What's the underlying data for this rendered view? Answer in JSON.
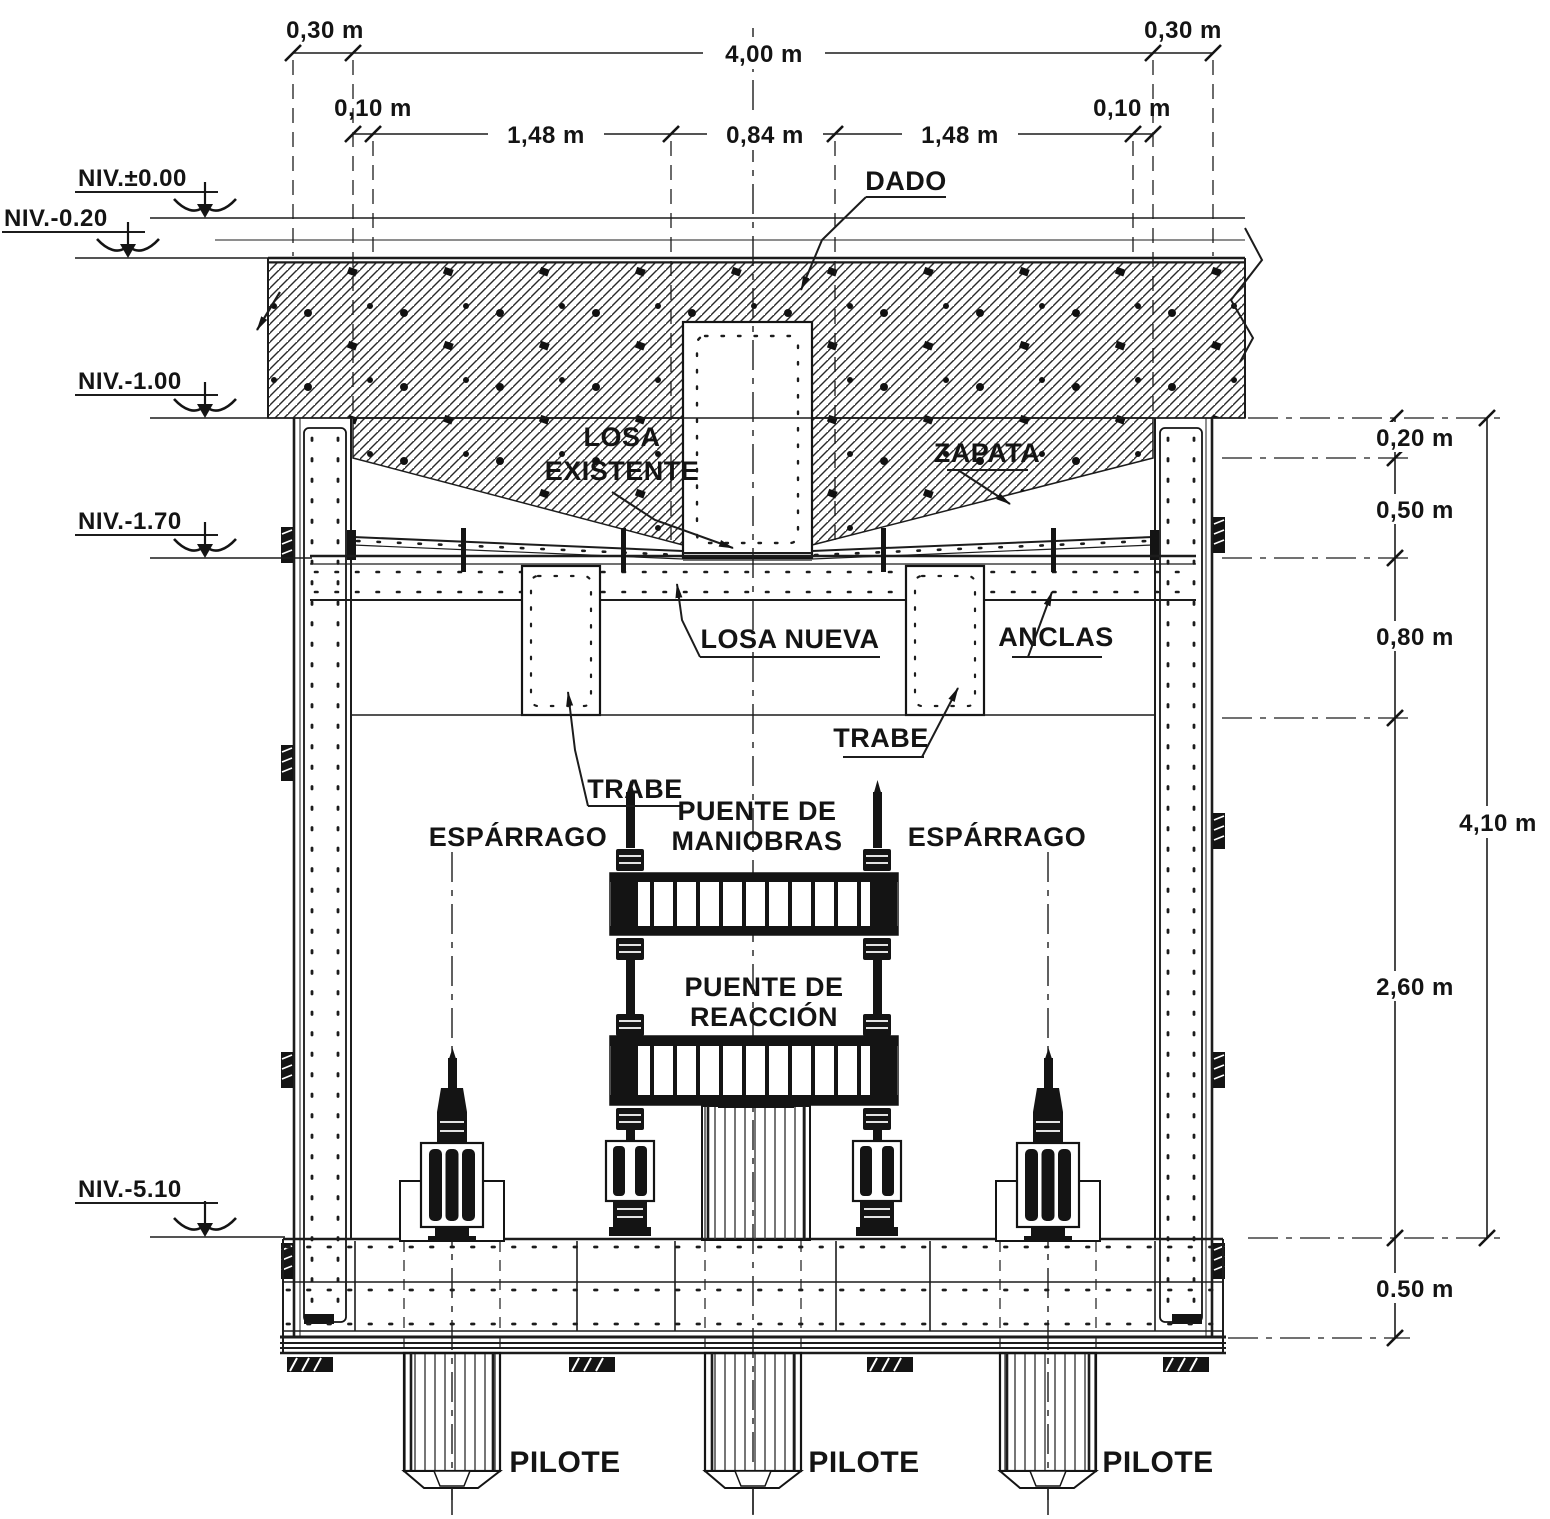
{
  "dims_top": {
    "d030_left": "0,30 m",
    "d400": "4,00 m",
    "d030_right": "0,30 m",
    "d010_left": "0,10 m",
    "d148_left": "1,48 m",
    "d084": "0,84 m",
    "d148_right": "1,48 m",
    "d010_right": "0,10 m"
  },
  "dims_right": {
    "d020": "0,20 m",
    "d050": "0,50 m",
    "d080": "0,80 m",
    "d410": "4,10 m",
    "d260": "2,60 m",
    "d050b": "0.50 m"
  },
  "levels": {
    "n000": "NIV.±0.00",
    "n020": "NIV.-0.20",
    "n100": "NIV.-1.00",
    "n170": "NIV.-1.70",
    "n510": "NIV.-5.10"
  },
  "labels": {
    "dado": "DADO",
    "losa_ex_1": "LOSA",
    "losa_ex_2": "EXISTENTE",
    "zapata": "ZAPATA",
    "losa_nueva": "LOSA NUEVA",
    "anclas": "ANCLAS",
    "trabe_l": "TRABE",
    "trabe_r": "TRABE",
    "esparrago_l": "ESPÁRRAGO",
    "esparrago_r": "ESPÁRRAGO",
    "pm_1": "PUENTE DE",
    "pm_2": "MANIOBRAS",
    "pr_1": "PUENTE DE",
    "pr_2": "REACCIÓN",
    "pilote_l": "PILOTE",
    "pilote_c": "PILOTE",
    "pilote_r": "PILOTE"
  }
}
